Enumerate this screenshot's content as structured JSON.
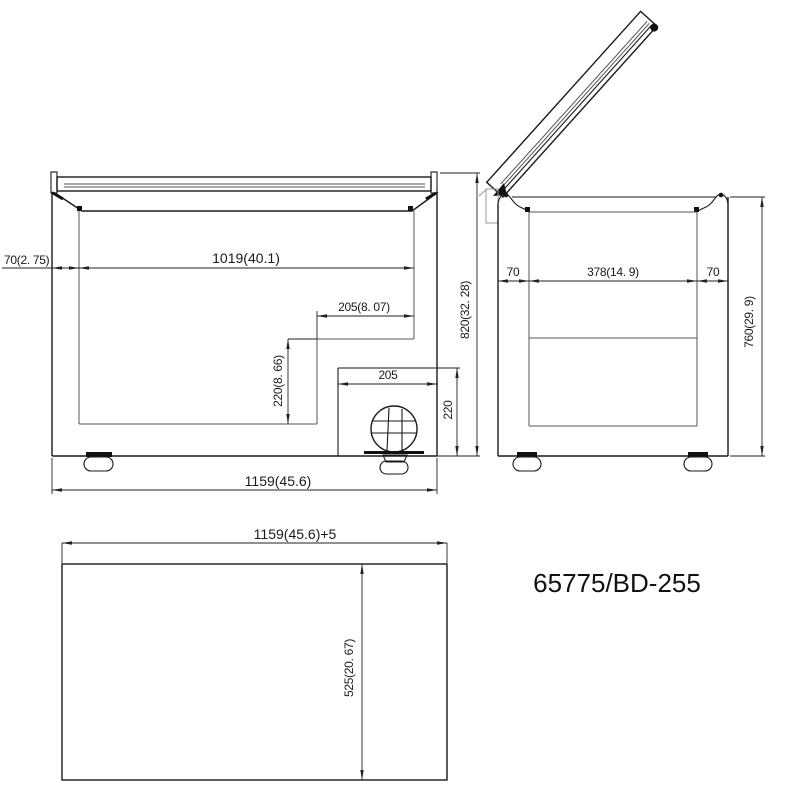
{
  "model_label": "65775/BD-255",
  "colors": {
    "line": "#1a1a1a",
    "background": "#ffffff"
  },
  "front_view": {
    "wall_thickness": "70(2. 75)",
    "interior_width": "1019(40.1)",
    "step_width": "205(8. 07)",
    "step_height": "220(8. 66)",
    "compressor_niche_width": "205",
    "compressor_niche_height": "220",
    "overall_height": "820(32. 28)",
    "overall_width": "1159(45.6)"
  },
  "side_view": {
    "left_wall_thickness": "70",
    "interior_depth": "378(14. 9)",
    "right_wall_thickness": "70",
    "overall_height": "760(29. 9)"
  },
  "top_view": {
    "overall_width_plus": "1159(45.6)+5",
    "interior_depth": "525(20. 67)"
  }
}
